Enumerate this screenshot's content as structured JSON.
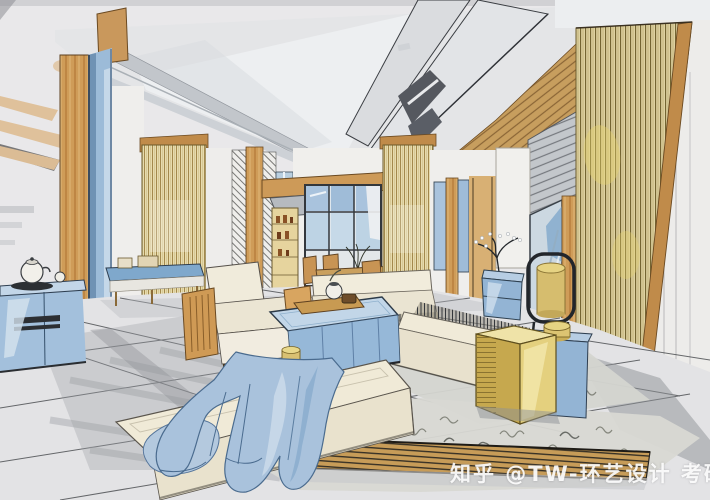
{
  "watermark": {
    "text": "知乎 @TW-环艺设计 考研"
  },
  "palette": {
    "paper": "#e9e8ea",
    "ceiling_gray": "#c2c6cb",
    "dark_ceiling_panel": "#55585f",
    "wood_tan": "#cf9c58",
    "slat_gold": "#ded2a2",
    "accent_blue": "#8fb2d4",
    "light_blue": "#bdd2e6",
    "cream_upholstery": "#efe9d6",
    "gold_cabinet": "#e4d07e",
    "floor_gray": "#e3e3e5",
    "ink_line": "#2e3237"
  }
}
